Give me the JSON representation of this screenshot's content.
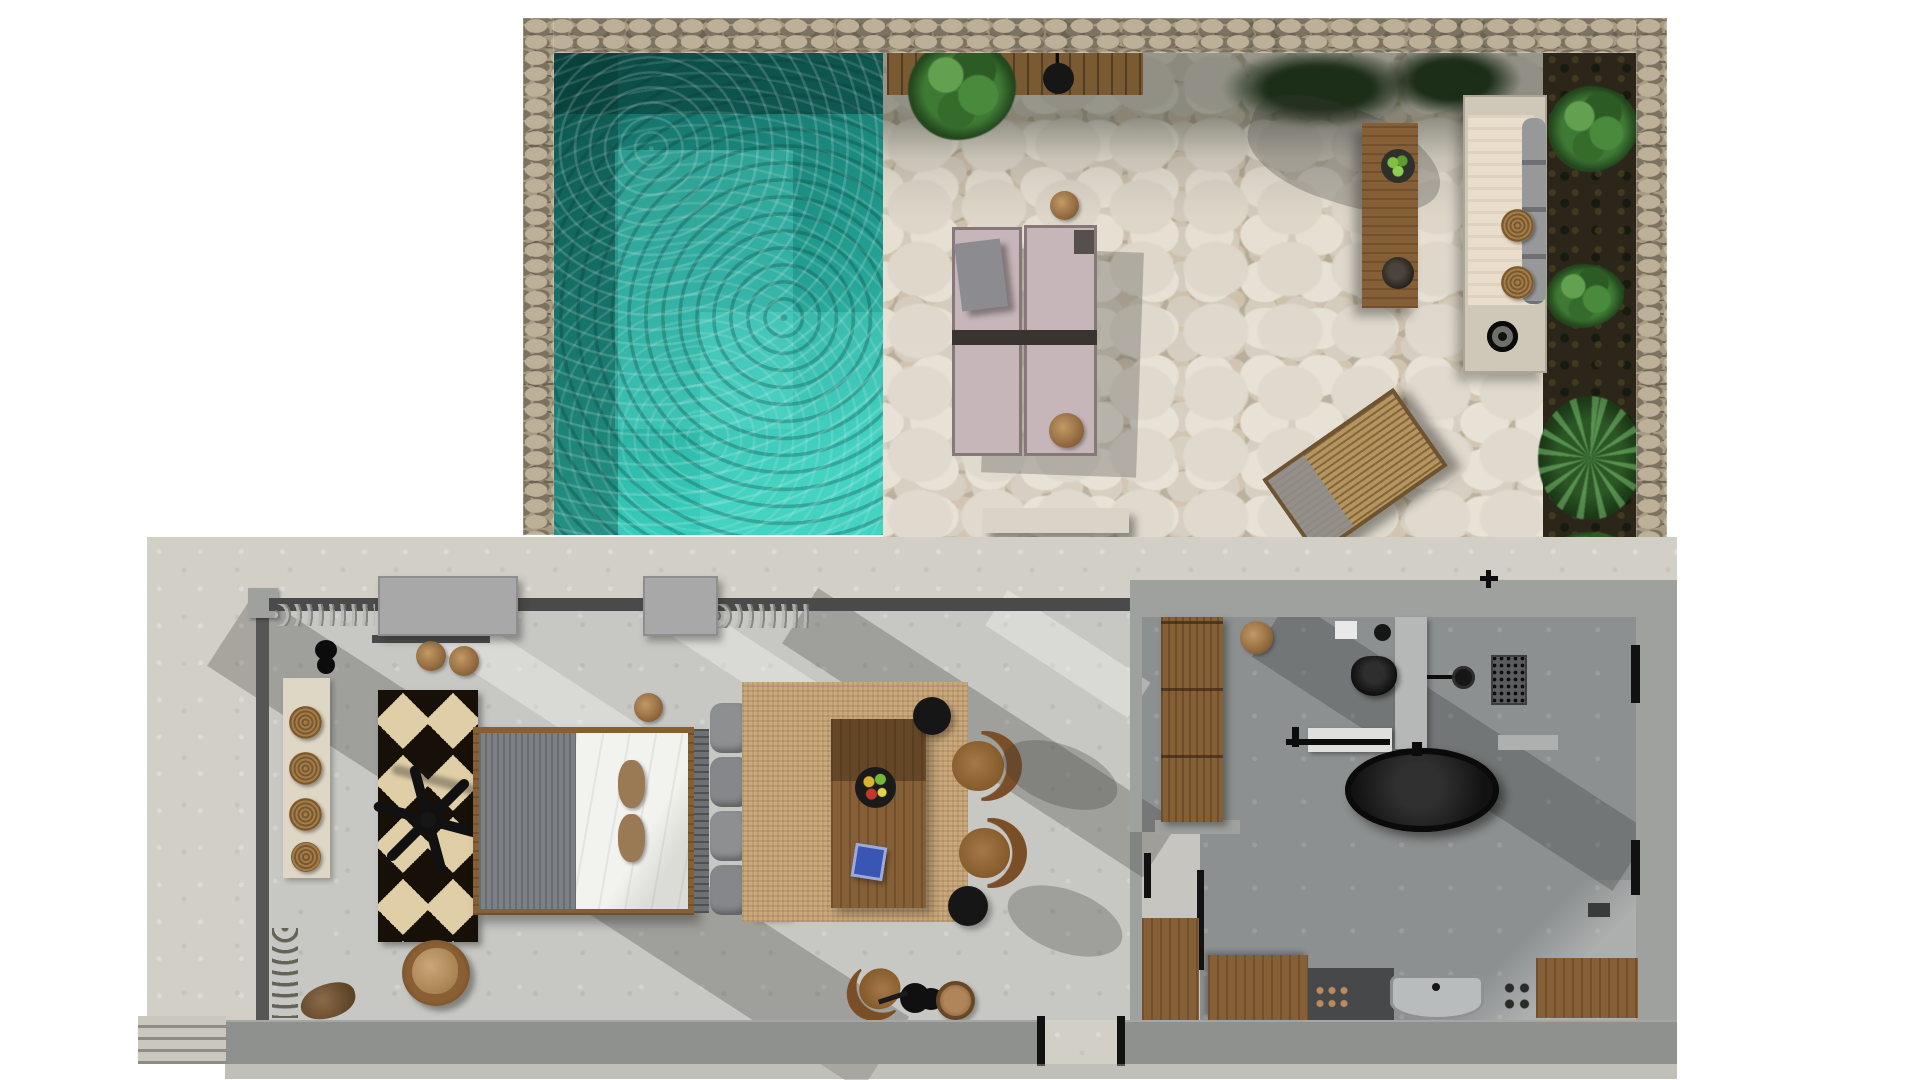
{
  "scene": {
    "label": "Top-down 3D rendered floor plan of a villa suite with private pool terrace",
    "render_type": "architectural plan render",
    "visible_text": "none"
  },
  "palette": {
    "background": "#ffffff",
    "stone_wall": "#8f8472",
    "pool_deep": "#11655e",
    "pool_mid": "#1f968a",
    "pool_bright": "#38cbb9",
    "flagstone_gap": "#b3a894",
    "concrete": "#d2cfc7",
    "interior_floor": "#c7c7c3",
    "bathroom_floor": "#8d9090",
    "wall_gray": "#9fa19f",
    "wall_dark": "#4a4a4a",
    "wood": "#855f36",
    "deck_wood": "#7a5a33",
    "daybed": "#c6b5b9",
    "bench_cushion": "#e9decb",
    "jute": "#c9a97d",
    "rug_dark": "#171008",
    "rug_cream": "#e0cea6",
    "blanket": "#7d8186",
    "duvet": "#f2f2ef",
    "pillow": "#9a7a55",
    "black_fixture": "#141414",
    "soil": "#2b2619",
    "greenery": "#3f7a34"
  },
  "areas": {
    "terrace": {
      "label": "Walled pool terrace with flagstone paving"
    },
    "pool": {
      "label": "Private plunge pool"
    },
    "deck": {
      "label": "Timber deck strip with black fire pendant"
    },
    "garden": {
      "label": "Planting beds with shrubs and palm"
    },
    "bedroom": {
      "label": "Bedroom"
    },
    "living": {
      "label": "Lounge and dining area"
    },
    "bathroom": {
      "label": "Bathroom with freestanding tub and shower"
    },
    "kitchenette": {
      "label": "Kitchenette"
    },
    "entry": {
      "label": "Entry door in south wall"
    },
    "steps": {
      "label": "Exterior steps"
    },
    "patio": {
      "label": "Concrete patio apron"
    }
  },
  "objects": {
    "daybeds": {
      "label": "Pair of cushioned sun daybeds with centre tray",
      "color": "#c6b5b9"
    },
    "wicker_lounger": {
      "label": "Woven rattan lounger set diagonally",
      "color": "#b6945f"
    },
    "outdoor_table": {
      "label": "Outdoor wooden dining table with bowl of limes and dark bowl"
    },
    "built_in_bench": {
      "label": "Built-in masonry bench with cushion, bolsters, two woven platters and fire bowl"
    },
    "side_stools": {
      "label": "Round timber side stools"
    },
    "fire_pendant": {
      "label": "Black fire pendant over deck"
    },
    "bed": {
      "label": "Double bed with grey knit throw, white duvet and two tan pillows"
    },
    "diamond_rug": {
      "label": "Black and cream diamond motif rug"
    },
    "ceiling_fan": {
      "label": "Three-blade black ceiling fan"
    },
    "console": {
      "label": "Console with stacked woven platters"
    },
    "fur_chair": {
      "label": "Round timber chair with sheepskin"
    },
    "sofa": {
      "label": "Daybed sofa with grey bolster cushions"
    },
    "coffee_table": {
      "label": "Low wooden table on jute rug"
    },
    "fruit_bowl": {
      "label": "Bowl of fruit"
    },
    "dining_chairs": {
      "label": "Curved-back wooden chairs"
    },
    "black_stools": {
      "label": "Black round stools"
    },
    "guitar": {
      "label": "Guitar resting by the south wall"
    },
    "basket": {
      "label": "Woven basket"
    },
    "wardrobe": {
      "label": "Timber wardrobe bench"
    },
    "toilet": {
      "label": "Black wall-hung toilet"
    },
    "vanity": {
      "label": "Vanity counter with black fittings"
    },
    "bathtub": {
      "label": "Black freestanding oval bathtub"
    },
    "shower": {
      "label": "Walk-in shower with black rose and slot drain"
    },
    "kitchen_counters": {
      "label": "Timber kitchenette counters"
    },
    "hob": {
      "label": "Two-ring hob knobs"
    },
    "sink": {
      "label": "Grey kitchen sink"
    },
    "entry_door": {
      "label": "Entry door opening"
    },
    "driftwood": {
      "label": "Driftwood ornament"
    },
    "vine": {
      "label": "Decorative vine stem"
    }
  }
}
